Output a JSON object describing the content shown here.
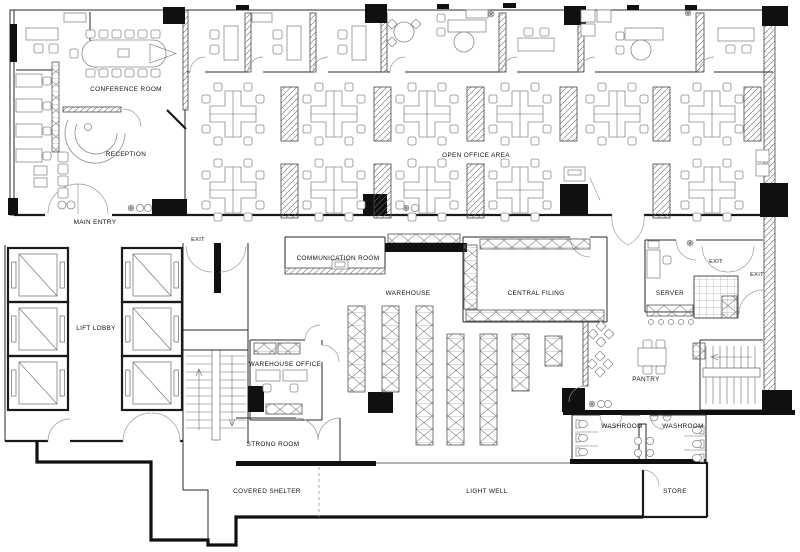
{
  "drawing": {
    "type": "office-floor-plan",
    "background": "#ffffff",
    "wall_color": "#1a1a1a",
    "furniture_color": "#8a8a8a"
  },
  "labels": {
    "conference_room": "CONFERENCE ROOM",
    "reception": "RECEPTION",
    "main_entry": "MAIN ENTRY",
    "open_office": "OPEN OFFICE AREA",
    "exit_stair": "EXIT",
    "communication_room": "COMMUNICATION ROOM",
    "warehouse": "WAREHOUSE",
    "central_filing": "CENTRAL FILING",
    "server": "SERVER",
    "exit_server": "EXIT",
    "exit_right": "EXIT",
    "lift_lobby": "LIFT LOBBY",
    "warehouse_office": "WAREHOUSE OFFICE",
    "pantry": "PANTRY",
    "strong_room": "STRONG ROOM",
    "washroom_left": "WASHROOM",
    "washroom_right": "WASHROOM",
    "store": "STORE",
    "covered_shelter": "COVERED SHELTER",
    "light_well": "LIGHT WELL"
  }
}
